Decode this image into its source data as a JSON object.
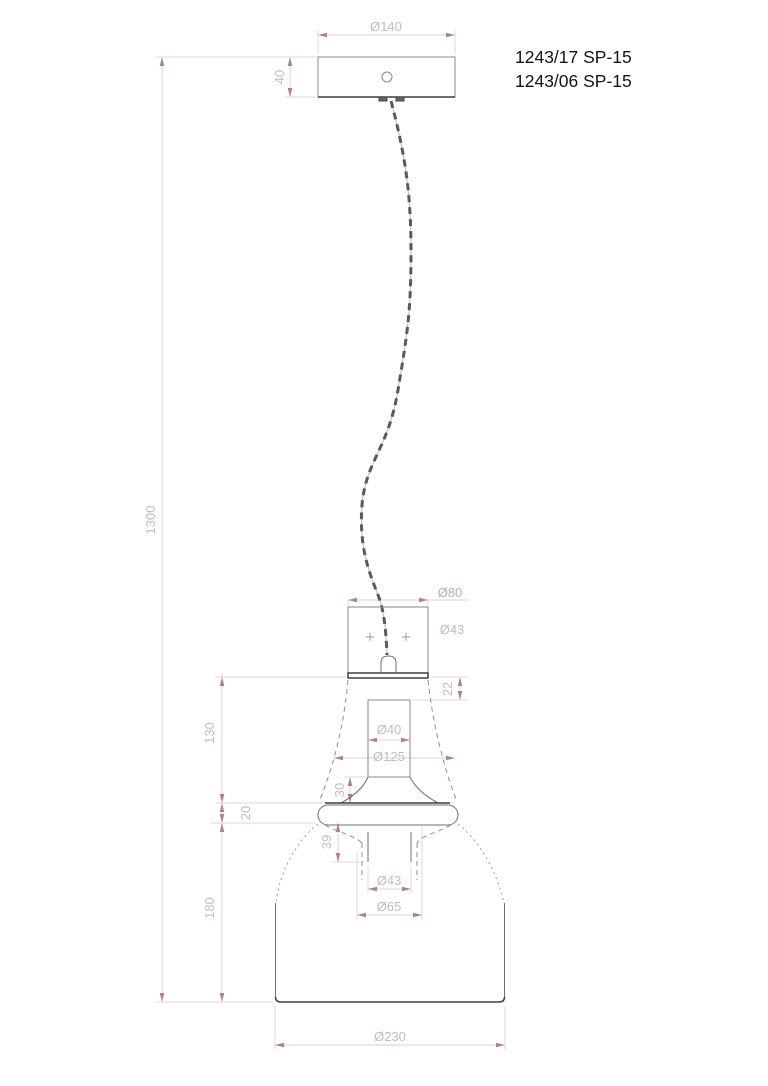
{
  "drawing_title": "pendant-lamp-technical-drawing",
  "product_labels": {
    "line1": "1243/17 SP-15",
    "line2": "1243/06 SP-15"
  },
  "dimensions": {
    "canopy_diameter": "Ø140",
    "canopy_height": "40",
    "drop_length": "1300",
    "holder_width": "Ø80",
    "holder_inner_diameter": "Ø43",
    "holder_plate_offset": "22",
    "socket_tube_diameter": "Ø40",
    "bell_diameter": "Ø125",
    "bell_height": "130",
    "socket_to_rim": "30",
    "rim_height": "20",
    "neck_height": "39",
    "neck_inner_diameter": "Ø43",
    "neck_outer_diameter": "Ø65",
    "shade_height": "180",
    "shade_diameter": "Ø230"
  },
  "colors": {
    "background": "#ffffff",
    "outline": "#8a8a8a",
    "outline_dark": "#3f3f3f",
    "dimension_line": "#ddd3d3",
    "dimension_text": "#c6baba",
    "arrow": "#b87e7e",
    "label_text": "#141414",
    "cable": "#5a5a5a"
  }
}
